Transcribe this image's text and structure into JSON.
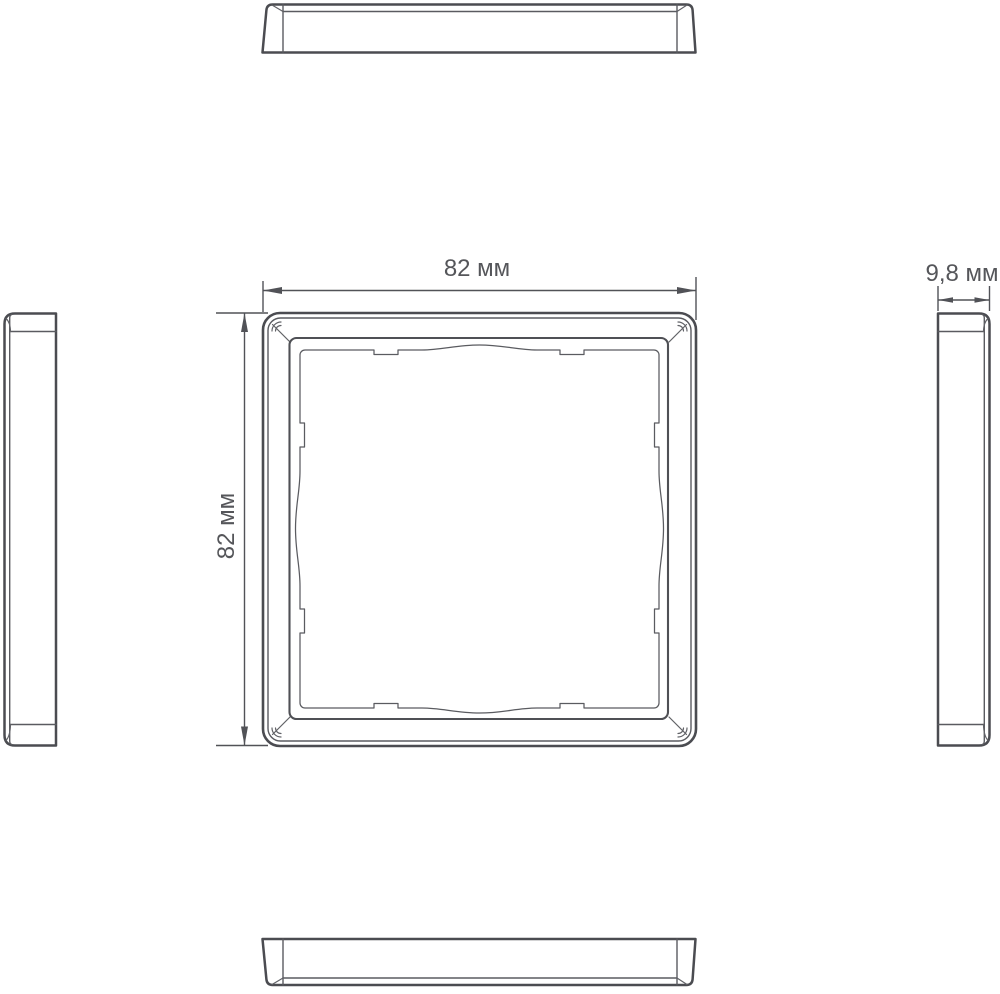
{
  "drawing": {
    "labels": {
      "width": "82 мм",
      "height": "82 мм",
      "depth": "9,8 мм"
    },
    "dimensions": {
      "width_mm": 82,
      "height_mm": 82,
      "depth_mm": 9.8,
      "unit": "мм"
    },
    "colors": {
      "line": "#4b4c51",
      "text": "#55565a",
      "background": "#ffffff"
    }
  }
}
